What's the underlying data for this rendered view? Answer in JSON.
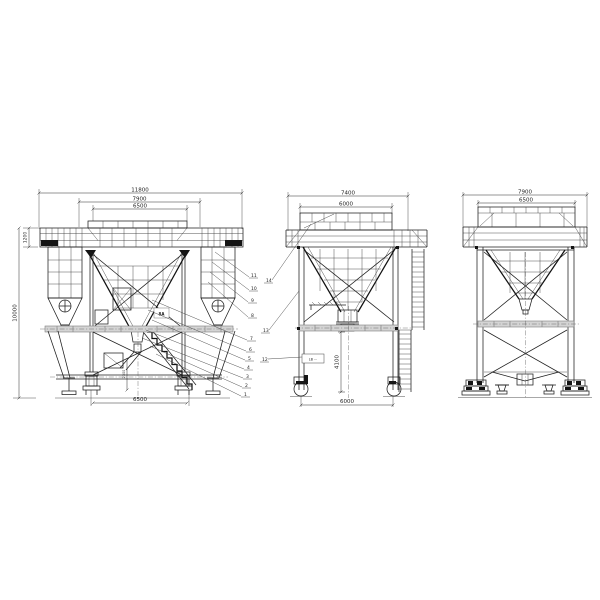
{
  "drawing": {
    "kind": "steel hopper / transfer bunker structure - three elevation views",
    "colors": {
      "background": "#ffffff",
      "line": "#1e1e1e",
      "gray_band": "#d4d4d4",
      "dim_text": "#1c1c1c"
    }
  },
  "front_view": {
    "dim_top_outer": "11800",
    "dim_top_mid": "7900",
    "dim_top_inner": "6500",
    "dim_left_upper": "1200",
    "dim_left_total": "10000",
    "dim_inner_vertical": "2300",
    "dim_bottom": "6500",
    "detail_label": "8A",
    "callouts": [
      "11",
      "10",
      "9",
      "8",
      "7",
      "6",
      "5",
      "4",
      "3",
      "2",
      "1"
    ]
  },
  "side_view": {
    "dim_top_outer": "7400",
    "dim_top_inner": "6000",
    "dim_height": "4100",
    "dim_bottom": "6000",
    "label_box": "LB ···",
    "callouts": [
      "14",
      "13",
      "12"
    ]
  },
  "rear_view": {
    "dim_top_outer": "7900",
    "dim_top_inner": "6500"
  }
}
